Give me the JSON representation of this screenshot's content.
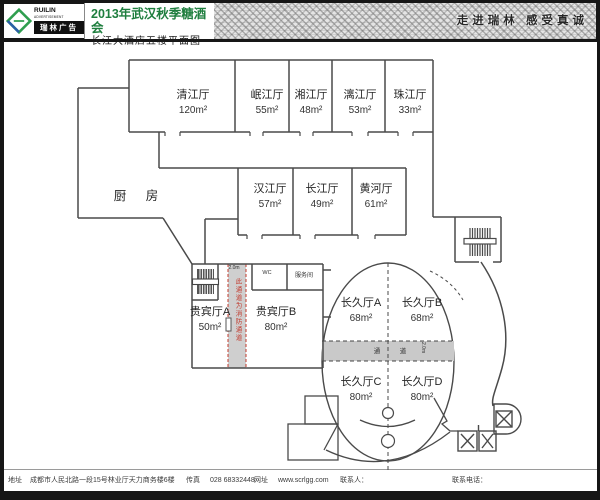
{
  "header": {
    "brand_en_top": "RUILIN",
    "brand_en_bottom": "ADVERTISEMENT",
    "brand_cn": "瑞林广告",
    "title": "2013年武汉秋季糖酒会",
    "subtitle": "长江大酒店五楼平面图",
    "slogan": "走进瑞林  感受真诚"
  },
  "plan": {
    "kitchen_label": "厨 房",
    "rooms": [
      {
        "name": "清江厅",
        "area": "120m²"
      },
      {
        "name": "岷江厅",
        "area": "55m²"
      },
      {
        "name": "湘江厅",
        "area": "48m²"
      },
      {
        "name": "漓江厅",
        "area": "53m²"
      },
      {
        "name": "珠江厅",
        "area": "33m²"
      },
      {
        "name": "汉江厅",
        "area": "57m²"
      },
      {
        "name": "长江厅",
        "area": "49m²"
      },
      {
        "name": "黄河厅",
        "area": "61m²"
      },
      {
        "name": "贵宾厅A",
        "area": "50m²"
      },
      {
        "name": "贵宾厅B",
        "area": "80m²"
      },
      {
        "name": "长久厅A",
        "area": "68m²"
      },
      {
        "name": "长久厅B",
        "area": "68m²"
      },
      {
        "name": "长久厅C",
        "area": "80m²"
      },
      {
        "name": "长久厅D",
        "area": "80m²"
      }
    ],
    "small_rooms": {
      "wc": "WC",
      "service": "服务间"
    },
    "fire_corridor": {
      "width_label": "2.0m",
      "note": "此通道为消防通道"
    },
    "center_aisle": {
      "char_left": "通",
      "char_right": "道",
      "width_label": "2.0m"
    }
  },
  "footer": {
    "address_label": "地址",
    "address": "成都市人民北路一段15号林业厅天力商务楼6楼",
    "fax_label": "传真",
    "fax": "028 68332448",
    "web_label": "网址",
    "web": "www.scrlgg.com",
    "contact_label": "联系人：",
    "phone_label": "联系电话："
  },
  "colors": {
    "title_green": "#1e7e3e",
    "wall": "#4a4a4a",
    "fire_red": "#c23b2e",
    "band_gray": "#c9c9c9"
  }
}
